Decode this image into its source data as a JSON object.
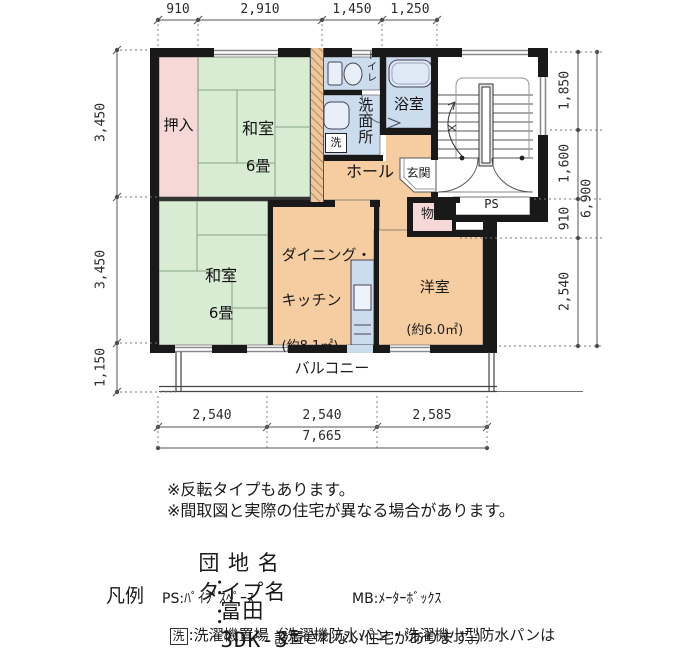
{
  "plan": {
    "dims_top": [
      "910",
      "2,910",
      "1,450",
      "1,250"
    ],
    "dims_left": [
      "3,450",
      "3,450",
      "1,150"
    ],
    "dims_right": [
      "1,850",
      "1,600",
      "910",
      "2,540"
    ],
    "dims_right_total": "6,900",
    "dims_bottom": [
      "2,540",
      "2,540",
      "2,585"
    ],
    "dims_bottom_total": "7,665",
    "rooms": {
      "oshiire": "押入",
      "washitsu1": "和室",
      "washitsu1_size": "6畳",
      "toilet": "トイレ",
      "washroom": "洗面所",
      "laundry_mark": "洗",
      "bath": "浴室",
      "hall": "ホール",
      "genkan": "玄関",
      "ps": "PS",
      "storage": "物入",
      "washitsu2": "和室",
      "washitsu2_size": "6畳",
      "dk_line1": "ダイニング・",
      "dk_line2": "キッチン",
      "dk_area": "(約8.1㎡)",
      "western": "洋室",
      "western_area": "(約6.0㎡)",
      "balcony": "バルコニー"
    }
  },
  "notes": [
    "※反転タイプもあります。",
    "※間取図と実際の住宅が異なる場合があります。"
  ],
  "info": {
    "danchi_label": "団 地 名",
    "colon": "：",
    "danchi_value": "富田",
    "type_label": "タイプ名",
    "type_value": "3DK-3"
  },
  "legend": {
    "title": "凡例",
    "ps": "PS:ﾊﾟｲﾌﾟｽﾍﾟｰｽ",
    "mb": "MB:ﾒｰﾀｰﾎﾞｯｸｽ",
    "laundry_mark": "洗",
    "laundry_text": ":洗濯機置場（洗濯機防水パン・洗濯機小型防水パンは",
    "laundry_text2": "設置されない住宅があります。）"
  }
}
